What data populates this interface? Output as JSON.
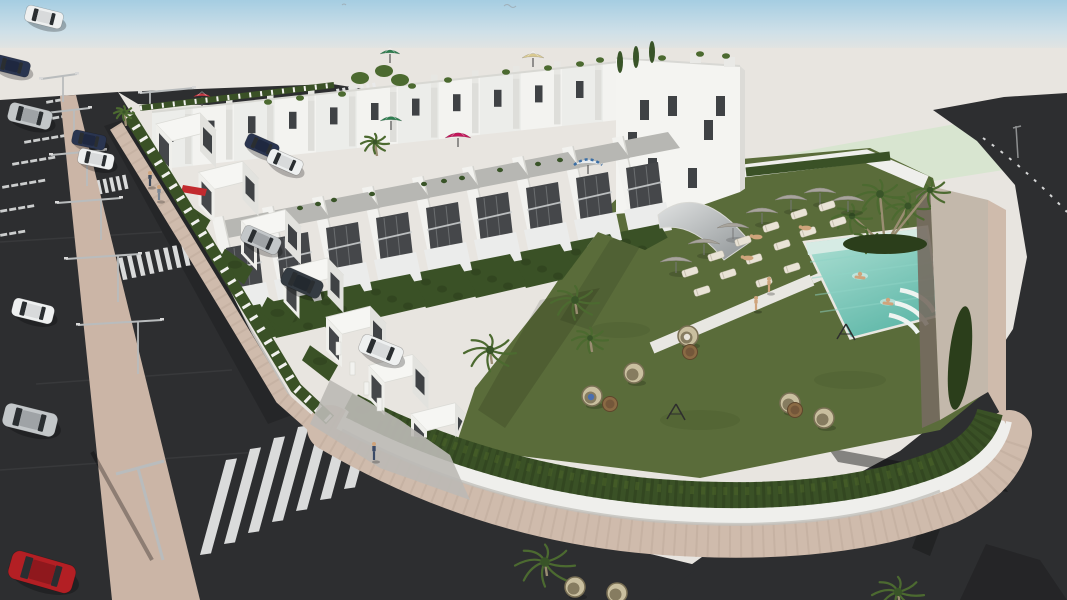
{
  "scene": {
    "label": "3D architectural rendering of a white townhouse residential complex with roof terraces, communal lawn, swimming pool, sun loungers, hedged gardens, streets with zebra crossings, street lights and parked cars"
  },
  "palette": {
    "sky_top": "#a5cde2",
    "sky_mid": "#cfe0e8",
    "ground": "#e8e5e0",
    "mint": "#d8e5d0",
    "asphalt": "#2d2e30",
    "asphalt_light": "#3b3c3e",
    "median": "#cbb5a6",
    "paver": "#cfbbac",
    "paver_dark": "#b49f90",
    "wall_white": "#efefec",
    "building_white": "#f4f4f1",
    "building_shade": "#e2e2de",
    "recess": "#45474a",
    "glass": "#3f4245",
    "hedge": "#3a5126",
    "hedge_dark": "#2b3e1b",
    "hedge_light": "#4a6228",
    "lawn": "#5a6c3a",
    "lawn_dark": "#4a5b2f",
    "pool_light": "#b2e2d6",
    "pool_deep": "#62b9aa",
    "tan_wall": "#c3b8ab",
    "tan_dark": "#756c60",
    "palm": "#4c6a30",
    "palm_dark": "#395428",
    "trunk": "#9a8d72",
    "parasol": "#a8a49c",
    "lounger": "#e9e3d6",
    "wicker": "#c9bf9f",
    "wicker_dark": "#7a7055",
    "table": "#8a6a44",
    "skin": "#cfa47c",
    "white_line": "#e9eaea",
    "metal": "#b9bcbd",
    "car_white": "#eef0f0",
    "car_silver": "#c3c7c9",
    "car_navy": "#2a3550",
    "car_dark": "#343b42",
    "car_red": "#b31f24"
  },
  "buildings": {
    "back_row": {
      "units": 12,
      "x0": 152,
      "y0": 112,
      "dx": 41,
      "dy": -4.4,
      "facade_h": 58
    },
    "tall_end": {
      "body": "616,58 740,66 740,192 700,206 616,214",
      "side": "740,66 749,74 749,186 740,192",
      "windows": [
        [
          640,
          100
        ],
        [
          668,
          96
        ],
        [
          704,
          120
        ],
        [
          648,
          158
        ],
        [
          688,
          168
        ],
        [
          716,
          96
        ],
        [
          628,
          132
        ]
      ],
      "chimneys": [
        [
          640,
          49
        ],
        [
          690,
          53
        ],
        [
          724,
          57
        ]
      ]
    },
    "middle_row": {
      "units": 9,
      "x0": 214,
      "y0": 252,
      "dx": 50,
      "dy": -10
    },
    "front_row": {
      "units": 7,
      "x0": 156,
      "y0": 124,
      "dx": 42.5,
      "dy": 48.3
    },
    "entrance_pillars": [
      [
        336,
        342
      ],
      [
        350,
        362
      ],
      [
        364,
        382
      ],
      [
        377,
        398
      ]
    ]
  },
  "rooftop": {
    "plants": [
      [
        268,
        102
      ],
      [
        300,
        98
      ],
      [
        342,
        94
      ],
      [
        412,
        86
      ],
      [
        448,
        80
      ],
      [
        506,
        72
      ],
      [
        548,
        68
      ],
      [
        600,
        60
      ],
      [
        662,
        58
      ],
      [
        700,
        54
      ],
      [
        726,
        56
      ],
      [
        580,
        64
      ]
    ],
    "cypress": [
      [
        620,
        62
      ],
      [
        636,
        57
      ],
      [
        652,
        52
      ]
    ],
    "corner_bushes": [
      [
        360,
        78
      ],
      [
        384,
        71
      ],
      [
        400,
        80
      ]
    ],
    "terrace_plants": [
      [
        300,
        208
      ],
      [
        334,
        200
      ],
      [
        372,
        194
      ],
      [
        424,
        184
      ],
      [
        462,
        178
      ],
      [
        500,
        170
      ],
      [
        538,
        164
      ],
      [
        560,
        160
      ],
      [
        318,
        204
      ],
      [
        444,
        181
      ]
    ],
    "umbrellas": [
      {
        "x": 202,
        "y": 97,
        "r": 9,
        "color": "#c43a44",
        "type": "solid"
      },
      {
        "x": 390,
        "y": 54,
        "r": 10,
        "color": "#2e7d4f",
        "type": "solid"
      },
      {
        "x": 533,
        "y": 58,
        "r": 11,
        "color": "#d9c98f",
        "type": "solid"
      },
      {
        "x": 391,
        "y": 121,
        "r": 11,
        "color": "#2e7d4f",
        "type": "solid"
      },
      {
        "x": 458,
        "y": 138,
        "r": 13,
        "color": "#c2185b",
        "type": "solid"
      },
      {
        "x": 588,
        "y": 165,
        "r": 14,
        "color": "#3a6ea5",
        "type": "striped"
      }
    ]
  },
  "pool": {
    "swimmers": [
      [
        860,
        274
      ],
      [
        888,
        300
      ]
    ]
  },
  "palms_pool": [
    [
      852,
      216,
      20
    ],
    [
      880,
      194,
      24
    ],
    [
      908,
      206,
      22
    ],
    [
      930,
      190,
      20
    ],
    [
      866,
      240,
      16
    ]
  ],
  "garden": {
    "parasols": [
      [
        676,
        262
      ],
      [
        704,
        244
      ],
      [
        733,
        228
      ],
      [
        762,
        213
      ],
      [
        791,
        200
      ],
      [
        820,
        193
      ],
      [
        848,
        201
      ]
    ],
    "loungers": {
      "angle": -18,
      "positions": [
        [
          690,
          272
        ],
        [
          716,
          256
        ],
        [
          743,
          241
        ],
        [
          771,
          227
        ],
        [
          799,
          214
        ],
        [
          827,
          206
        ],
        [
          702,
          291
        ],
        [
          728,
          274
        ],
        [
          754,
          259
        ],
        [
          782,
          245
        ],
        [
          808,
          232
        ],
        [
          838,
          222
        ],
        [
          764,
          282
        ],
        [
          792,
          268
        ]
      ]
    },
    "egg_chairs": {
      "positions": [
        [
          592,
          396
        ],
        [
          634,
          373
        ],
        [
          688,
          336
        ],
        [
          790,
          403
        ],
        [
          824,
          418
        ],
        [
          575,
          587
        ],
        [
          617,
          593
        ]
      ],
      "occupied": [
        0,
        2
      ],
      "occupant_colors": [
        "#4a6fae",
        "#e8e4da"
      ]
    },
    "tables": [
      [
        610,
        404
      ],
      [
        690,
        352
      ],
      [
        795,
        410
      ]
    ],
    "frames": [
      [
        675,
        412
      ],
      [
        845,
        332
      ]
    ],
    "palms": [
      [
        490,
        350,
        26
      ],
      [
        575,
        300,
        24
      ],
      [
        590,
        338,
        18
      ],
      [
        545,
        562,
        30
      ],
      [
        898,
        592,
        26
      ],
      [
        124,
        112,
        10
      ],
      [
        375,
        142,
        14
      ]
    ]
  },
  "street": {
    "lights": [
      [
        63,
        102,
        26,
        22,
        14
      ],
      [
        74,
        140,
        30,
        28,
        16
      ],
      [
        87,
        186,
        34,
        36,
        18
      ],
      [
        101,
        240,
        40,
        44,
        20
      ],
      [
        118,
        302,
        46,
        52,
        22
      ],
      [
        138,
        374,
        52,
        60,
        24
      ],
      [
        150,
        110,
        20,
        10,
        44
      ]
    ],
    "crosswalks": [
      {
        "x": 86,
        "y": 197,
        "n": 7,
        "sx": 6.5,
        "sy": -1.3,
        "w": 3.5,
        "h": 14,
        "skew": -3
      },
      {
        "x": 114,
        "y": 282,
        "n": 9,
        "sx": 9,
        "sy": -2,
        "w": 4.5,
        "h": 22,
        "skew": -5
      },
      {
        "x": 200,
        "y": 555,
        "n": 7,
        "sx": 24,
        "sy": -11,
        "w": 11,
        "h": 95,
        "skew": 26
      },
      {
        "x": 338,
        "y": 99,
        "n": 7,
        "sx": 6,
        "sy": -1,
        "w": 3,
        "h": 10,
        "skew": -2
      }
    ],
    "tick_rows": [
      [
        34,
        120,
        4
      ],
      [
        24,
        141,
        5
      ],
      [
        12,
        163,
        5
      ],
      [
        2,
        186,
        5
      ],
      [
        0,
        210,
        4
      ],
      [
        46,
        101,
        3
      ],
      [
        0,
        234,
        3
      ]
    ],
    "cars": [
      {
        "x": 44,
        "y": 17,
        "angle": 14,
        "len": 38,
        "color": "white"
      },
      {
        "x": 12,
        "y": 66,
        "angle": 14,
        "len": 36,
        "color": "navy"
      },
      {
        "x": 30,
        "y": 116,
        "angle": 14,
        "len": 44,
        "color": "silver"
      },
      {
        "x": 89,
        "y": 140,
        "angle": 12,
        "len": 34,
        "color": "navy"
      },
      {
        "x": 96,
        "y": 159,
        "angle": 12,
        "len": 36,
        "color": "white"
      },
      {
        "x": 33,
        "y": 311,
        "angle": 14,
        "len": 42,
        "color": "white"
      },
      {
        "x": 30,
        "y": 420,
        "angle": 14,
        "len": 54,
        "color": "silver"
      },
      {
        "x": 42,
        "y": 572,
        "angle": 16,
        "len": 66,
        "color": "red"
      },
      {
        "x": 262,
        "y": 146,
        "angle": 24,
        "len": 34,
        "color": "navy"
      },
      {
        "x": 285,
        "y": 162,
        "angle": 24,
        "len": 36,
        "color": "white"
      },
      {
        "x": 261,
        "y": 240,
        "angle": 24,
        "len": 40,
        "color": "silver"
      },
      {
        "x": 302,
        "y": 283,
        "angle": 24,
        "len": 42,
        "color": "dark"
      },
      {
        "x": 381,
        "y": 350,
        "angle": 22,
        "len": 44,
        "color": "white"
      }
    ]
  },
  "people": [
    {
      "x": 150,
      "y": 186,
      "h": 13,
      "color": "#3d4a5c"
    },
    {
      "x": 159,
      "y": 200,
      "h": 13,
      "color": "#7a8694"
    },
    {
      "x": 374,
      "y": 460,
      "h": 16,
      "color": "#3a4a66"
    },
    {
      "x": 769,
      "y": 292,
      "h": 13,
      "color": "#cfa47c"
    },
    {
      "x": 756,
      "y": 310,
      "h": 12,
      "color": "#cfa47c"
    },
    {
      "x": 757,
      "y": 237,
      "h": 8,
      "color": "#cfa47c"
    },
    {
      "x": 806,
      "y": 228,
      "h": 8,
      "color": "#cfa47c"
    },
    {
      "x": 748,
      "y": 258,
      "h": 8,
      "color": "#cfa47c"
    }
  ]
}
